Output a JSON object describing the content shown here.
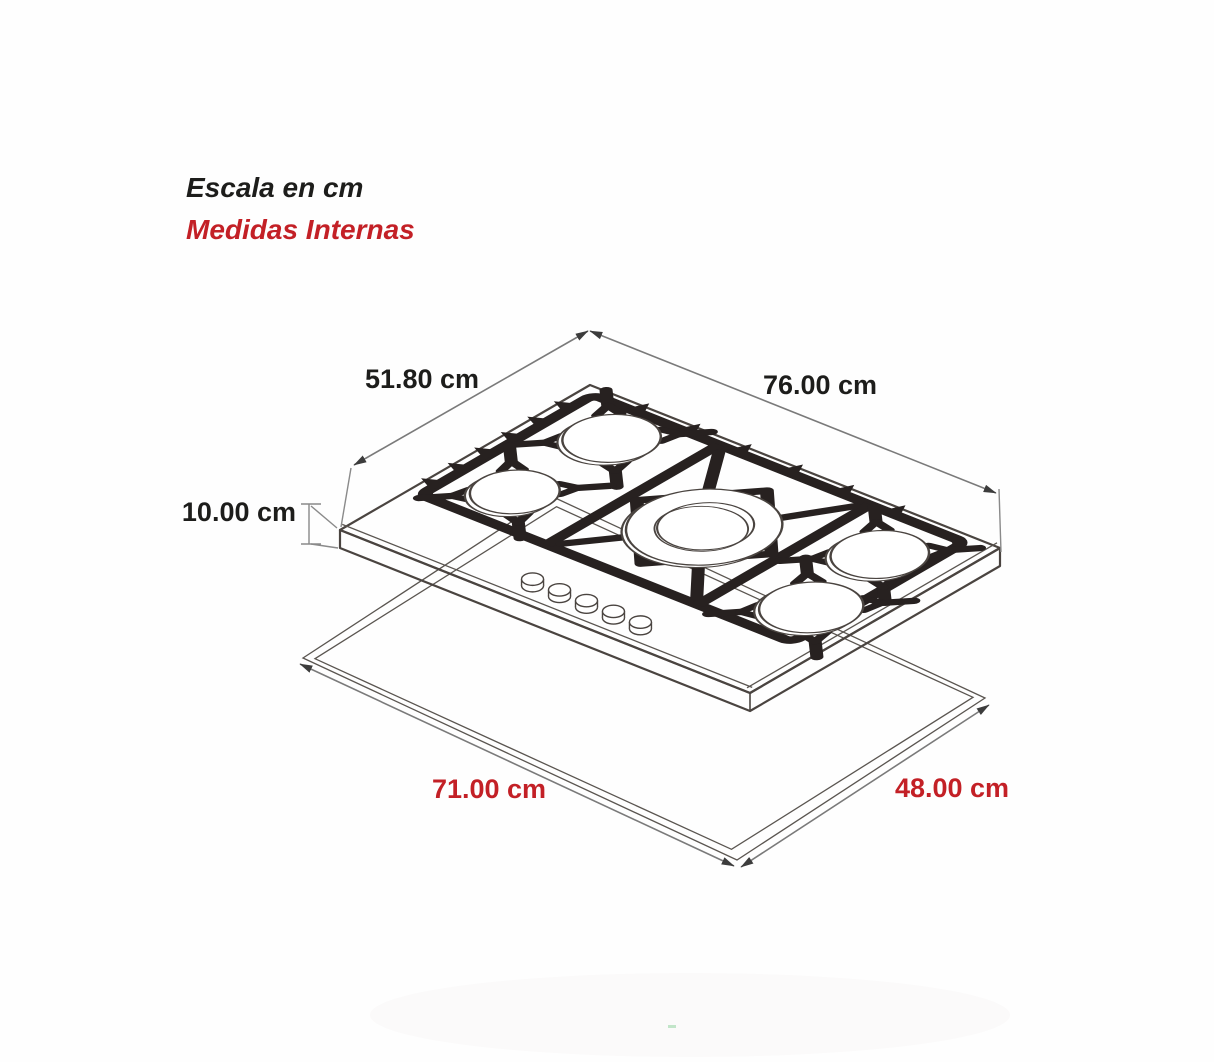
{
  "title": {
    "line1": "Escala en cm",
    "line2": "Medidas Internas"
  },
  "dimensions": {
    "top_depth": {
      "label": "51.80 cm",
      "value_cm": 51.8,
      "color": "black",
      "measures": "cooktop top depth (left back edge)"
    },
    "top_width": {
      "label": "76.00 cm",
      "value_cm": 76.0,
      "color": "black",
      "measures": "cooktop top width (right back edge)"
    },
    "edge_height": {
      "label": "10.00 cm",
      "value_cm": 10.0,
      "color": "black",
      "measures": "cooktop body edge height"
    },
    "cutout_width": {
      "label": "71.00 cm",
      "value_cm": 71.0,
      "color": "red",
      "measures": "counter cutout width (internal)"
    },
    "cutout_depth": {
      "label": "48.00 cm",
      "value_cm": 48.0,
      "color": "red",
      "measures": "counter cutout depth (internal)"
    }
  },
  "colors": {
    "background": "#fefefe",
    "black_text": "#1d1d1b",
    "red_text": "#c32026",
    "drawing_outline": "#4a4440",
    "grate_black": "#272120",
    "dimension_line_gray": "#7a7a7a"
  },
  "subject": {
    "type": "5-burner gas cooktop isometric technical drawing",
    "burner_count": 5,
    "knob_count": 5
  },
  "drawing": {
    "matrix": [
      5.395,
      2.145,
      -4.826,
      2.799,
      590,
      385
    ],
    "plan_width_cm": 76,
    "plan_depth_cm": 51.8,
    "frame": {
      "u0": 2.2,
      "v0": 1.8,
      "u1": 71,
      "v1": 37.5
    },
    "dividers": [
      25.5,
      53.5
    ],
    "feet_left_v": [
      6.5,
      12,
      17.5,
      23,
      28.5,
      34
    ],
    "feet_back_u": [
      10,
      19.5,
      29,
      38.5,
      48,
      57.5
    ],
    "diamond": [
      [
        39.5,
        7.5
      ],
      [
        52,
        20.5
      ],
      [
        39.5,
        33.5
      ],
      [
        27,
        20.5
      ]
    ],
    "center_arms": [
      [
        27,
        3.5,
        33.8,
        13.5
      ],
      [
        52,
        3.5,
        45.2,
        13.5
      ],
      [
        52,
        36,
        45.2,
        28
      ],
      [
        27,
        36,
        33.8,
        28
      ]
    ],
    "burners": [
      {
        "name": "back-left",
        "u": 12.5,
        "v": 9.5,
        "r": 6.8
      },
      {
        "name": "front-left",
        "u": 12.0,
        "v": 29.0,
        "r": 6.2
      },
      {
        "name": "center-large",
        "u": 39.5,
        "v": 20.5,
        "r": 10.8,
        "inner": 6.7,
        "center": true
      },
      {
        "name": "back-right",
        "u": 64.0,
        "v": 11.5,
        "r": 6.8
      },
      {
        "name": "front-right",
        "u": 66.5,
        "v": 28.5,
        "r": 7.2
      }
    ],
    "knobs": [
      [
        30.5,
        46
      ],
      [
        35.5,
        46
      ],
      [
        40.5,
        46
      ],
      [
        45.5,
        46
      ],
      [
        50.5,
        46
      ]
    ]
  }
}
